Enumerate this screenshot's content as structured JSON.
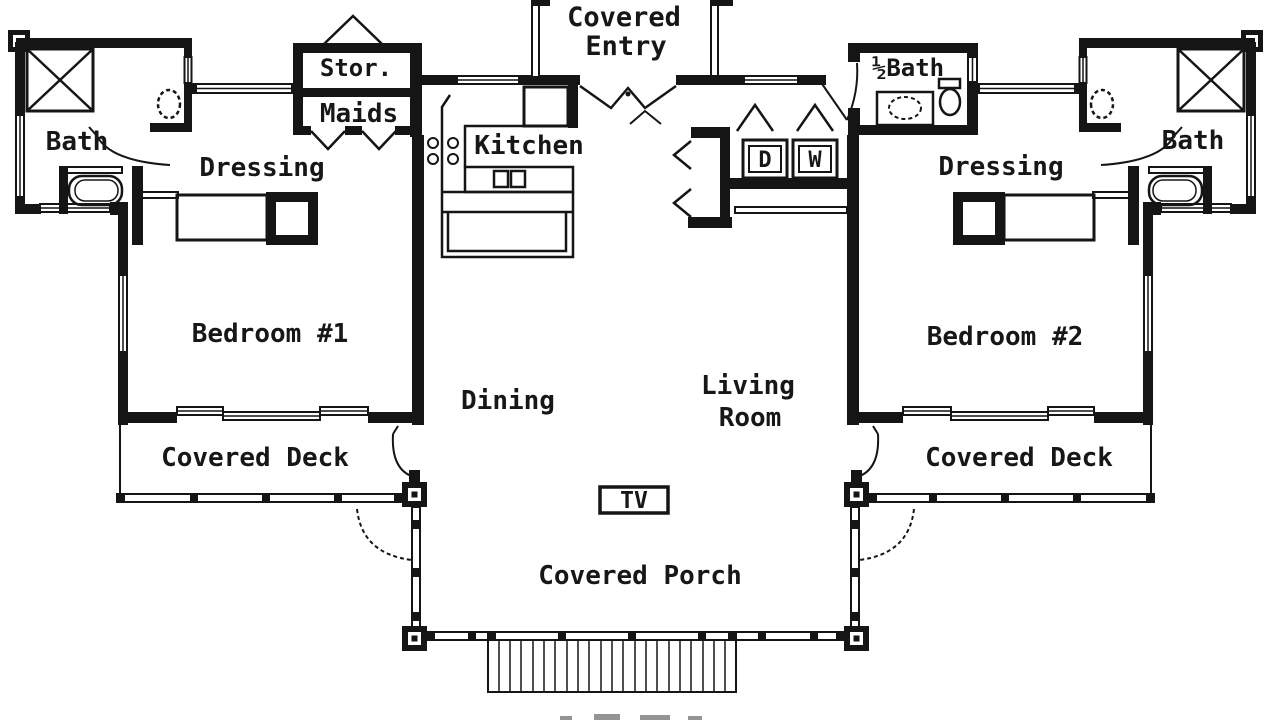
{
  "plan": {
    "type": "floor-plan",
    "ink_color": "#151515",
    "background_color": "#ffffff",
    "rooms": {
      "covered_entry_line1": "Covered",
      "covered_entry_line2": "Entry",
      "storage": "Stor.",
      "maids": "Maids",
      "kitchen": "Kitchen",
      "bath_left": "Bath",
      "bath_right": "Bath",
      "dressing_left": "Dressing",
      "dressing_right": "Dressing",
      "half_bath": "½Bath",
      "bedroom1": "Bedroom #1",
      "bedroom2": "Bedroom #2",
      "dining": "Dining",
      "living_line1": "Living",
      "living_line2": "Room",
      "covered_deck_left": "Covered Deck",
      "covered_deck_right": "Covered Deck",
      "covered_porch": "Covered Porch",
      "tv": "TV",
      "dryer": "D",
      "washer": "W"
    }
  }
}
